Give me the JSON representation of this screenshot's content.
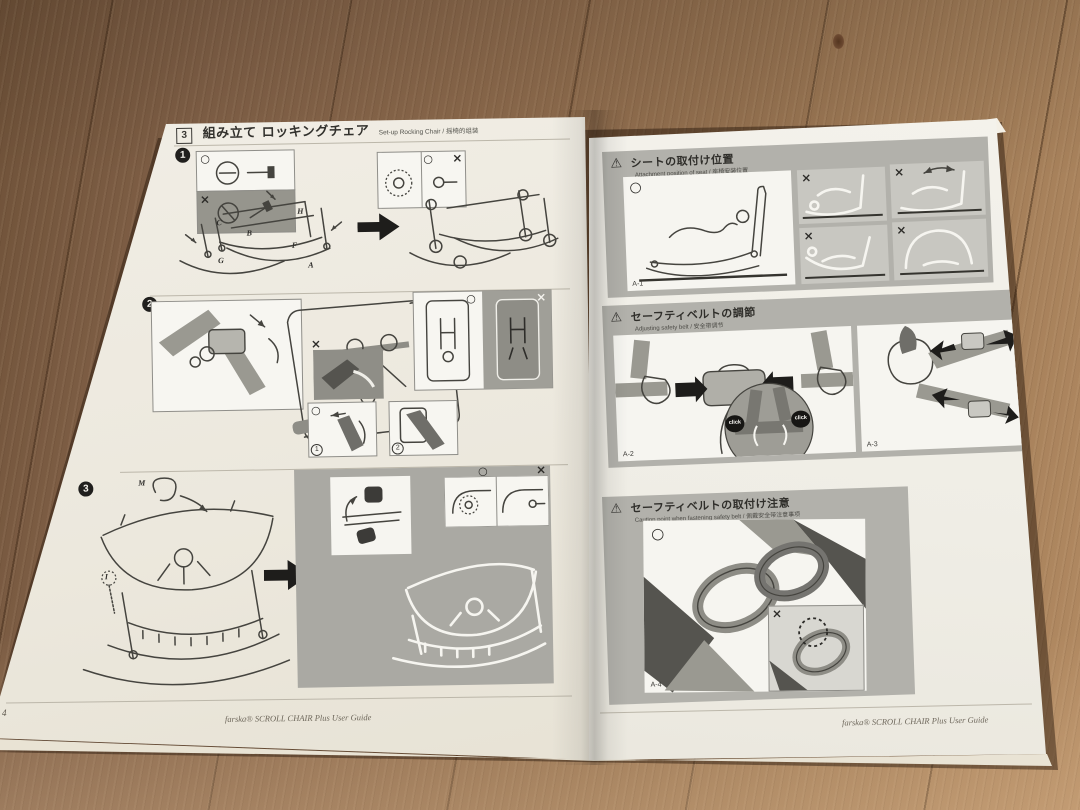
{
  "colors": {
    "wood": "#8a684b",
    "paper": "#efece3",
    "panel_gray": "#b2b1ab",
    "panel_light": "#c8c7c1",
    "ink": "#35342f",
    "black": "#1e1d1b"
  },
  "marks": {
    "ok": "○",
    "ng": "×",
    "warning": "⚠",
    "click": "click"
  },
  "left_page": {
    "header": {
      "step_no": "3",
      "title": "組み立て ロッキングチェア",
      "subtitle": "Set-up Rocking Chair / 摇椅的组装"
    },
    "steps": [
      {
        "num": "1",
        "labels": {
          "A": "A",
          "B": "B",
          "C": "C",
          "F": "F",
          "G": "G",
          "H": "H"
        }
      },
      {
        "num": "2",
        "labels": {
          "D": "D",
          "E": "E",
          "K": "K",
          "L": "L"
        },
        "substeps": [
          "1",
          "2"
        ]
      },
      {
        "num": "3",
        "labels": {
          "M": "M",
          "I": "I"
        }
      }
    ],
    "footer": {
      "page": "4",
      "brand": "farska® SCROLL CHAIR Plus User Guide"
    }
  },
  "right_page": {
    "sections": [
      {
        "title": "シートの取付け位置",
        "subtitle": "Attachment position of seat / 座椅安装位置",
        "fig_label": "A-1"
      },
      {
        "title": "セーフティベルトの調節",
        "subtitle": "Adjusting safety belt / 安全带调节",
        "fig_a": "A-2",
        "fig_b": "A-3"
      },
      {
        "title": "セーフティベルトの取付け注意",
        "subtitle": "Caution point when fastening safety belt / 佩戴安全带注意事项",
        "fig_label": "A-4"
      }
    ],
    "footer": {
      "brand": "farska® SCROLL CHAIR Plus User Guide"
    }
  }
}
